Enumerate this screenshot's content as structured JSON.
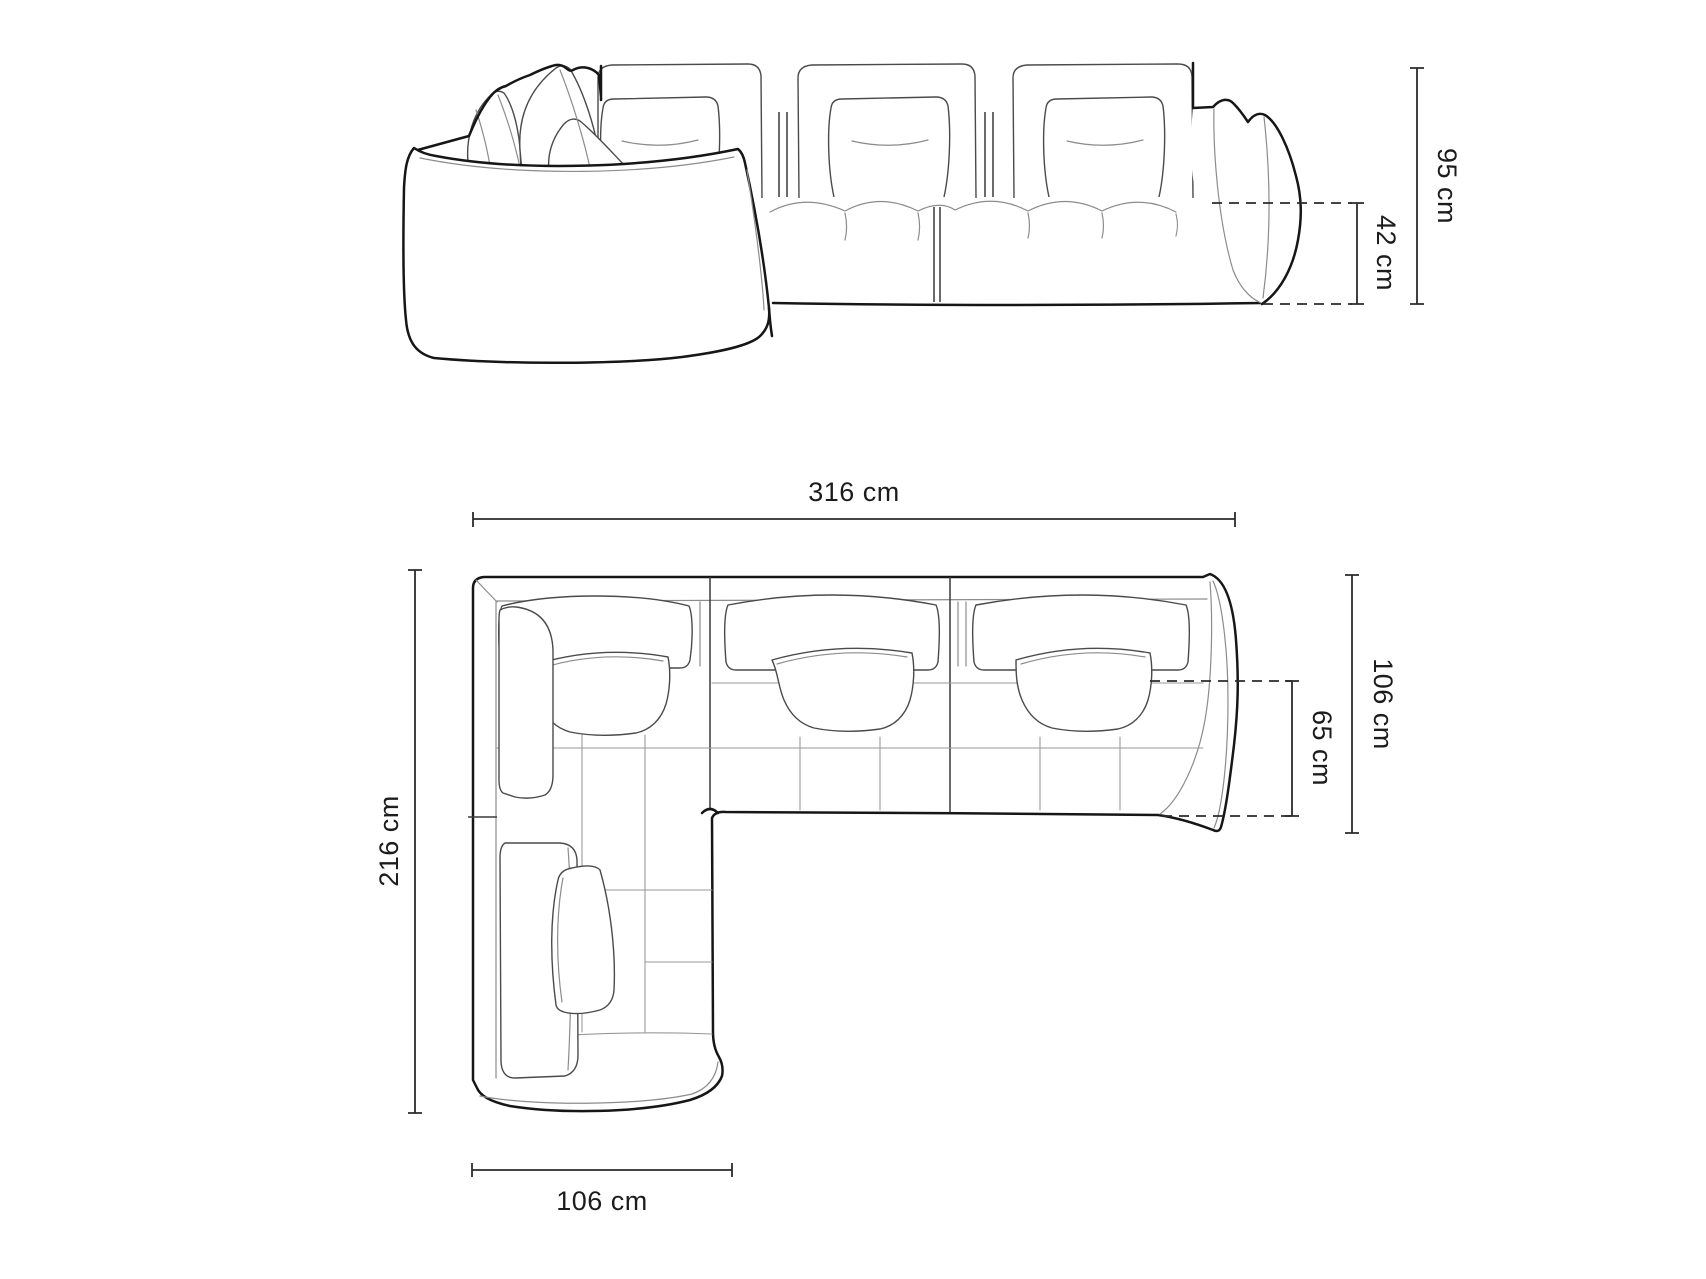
{
  "diagram": {
    "subject": "modular corner sofa technical dimension drawing",
    "views": {
      "front_elevation": {
        "label": "front elevation",
        "dimensions": {
          "total_height": "95 cm",
          "seat_height": "42 cm"
        }
      },
      "top_plan": {
        "label": "top plan view",
        "dimensions": {
          "total_width": "316 cm",
          "total_depth": "106 cm",
          "seat_depth": "65 cm",
          "total_length": "216 cm",
          "chaise_width": "106 cm"
        }
      }
    },
    "colors": {
      "background": "#ffffff",
      "outline": "#161616",
      "crease": "#8c8c8c",
      "dimension_line": "#2b2b2b",
      "label_text": "#1c1c1c"
    }
  }
}
